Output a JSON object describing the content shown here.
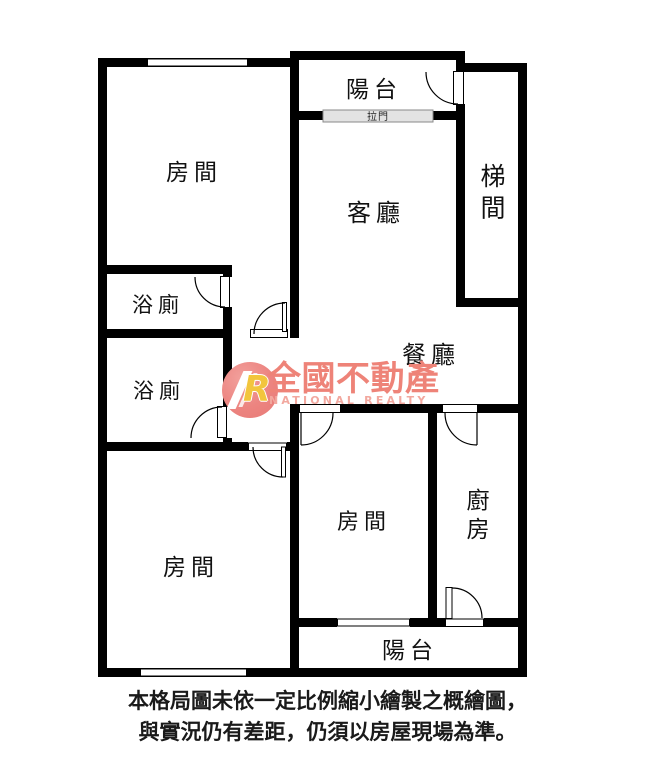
{
  "colors": {
    "wall": "#000000",
    "background": "#ffffff",
    "sliding_door_fill": "#e3e3e3",
    "sliding_door_border": "#8a8a8a",
    "watermark_circle": "#ec8480",
    "watermark_brand": "#ee8378",
    "watermark_brand_en": "#f2a89f",
    "watermark_logo_letter": "#f2c53d"
  },
  "rooms": {
    "balcony_top": "陽台",
    "sliding_door": "拉門",
    "bedroom_top_left": "房間",
    "living_room": "客廳",
    "stairwell": "梯間",
    "bathroom_1": "浴廁",
    "bathroom_2": "浴廁",
    "dining_room": "餐廳",
    "bedroom_middle": "房間",
    "kitchen": "廚房",
    "bedroom_bottom_left": "房間",
    "balcony_bottom": "陽台"
  },
  "watermark": {
    "logo_letter": "R",
    "brand": "全國不動產",
    "brand_en": "NATIONAL REALTY"
  },
  "disclaimer": {
    "line1": "本格局圖未依一定比例縮小繪製之概繪圖，",
    "line2": "與實況仍有差距，仍須以房屋現場為準。"
  }
}
